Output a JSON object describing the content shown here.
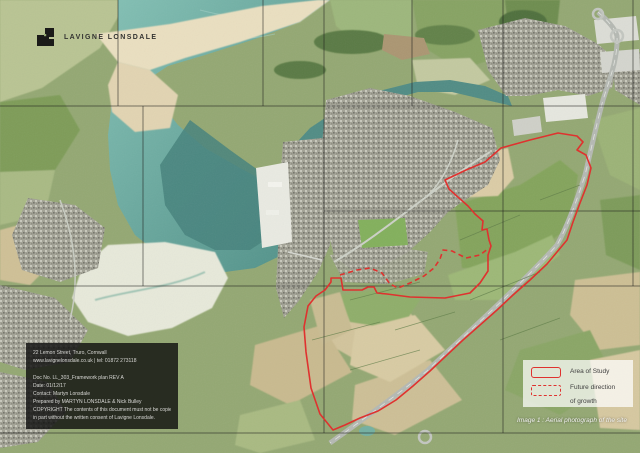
{
  "brand": {
    "name": "LAVIGNE LONSDALE"
  },
  "info_box": {
    "lines": [
      "22 Lemon Street, Truro, Cornwall",
      "www.lavignelonsdale.co.uk  |  tel: 01872 273118",
      "Doc No. LL_303_Framework plan  REV A",
      "Date: 01/12/17",
      "Contact: Martyn Lonsdale",
      "Prepared by MARTYN LONSDALE & Nick Bulley",
      "COPYRIGHT The contents of this document must not be copied or reproduced in whole or",
      "in part without the written consent of Lavigne Lonsdale."
    ]
  },
  "legend": {
    "area_label": "Area of Study",
    "growth_label_line1": "Future direction",
    "growth_label_line2": "of growth"
  },
  "caption": "Image 1 : Aerial photograph of the site",
  "colors": {
    "study_red": "#df322f",
    "seam": "rgba(30,30,28,0.55)",
    "water": "#5e9d95",
    "sand": "#eadfc0"
  },
  "map": {
    "study_area_points": "445,180 466,170 485,162 501,148 530,140 558,133 577,136 583,142 577,150 586,155 591,168 587,185 580,203 573,222 567,240 547,264 530,280 513,295 497,310 480,325 463,340 447,355 430,371 413,386 396,400 378,411 360,418 345,425 333,430 320,414 311,388 306,352 304,327 308,306 316,296 325,290 331,282 331,278 341,278 343,290 362,290 368,287 374,287 377,293 387,294 410,297 445,298 470,293 480,283 488,271 488,255 491,246 489,240 487,229 482,230 483,221 475,214 468,206 459,198 449,189",
    "growth_line_points": "340,275 357,270 370,268 382,273 390,284 398,288 410,283 424,276 434,268 440,259 443,250 452,251 466,258 480,255 489,248"
  }
}
